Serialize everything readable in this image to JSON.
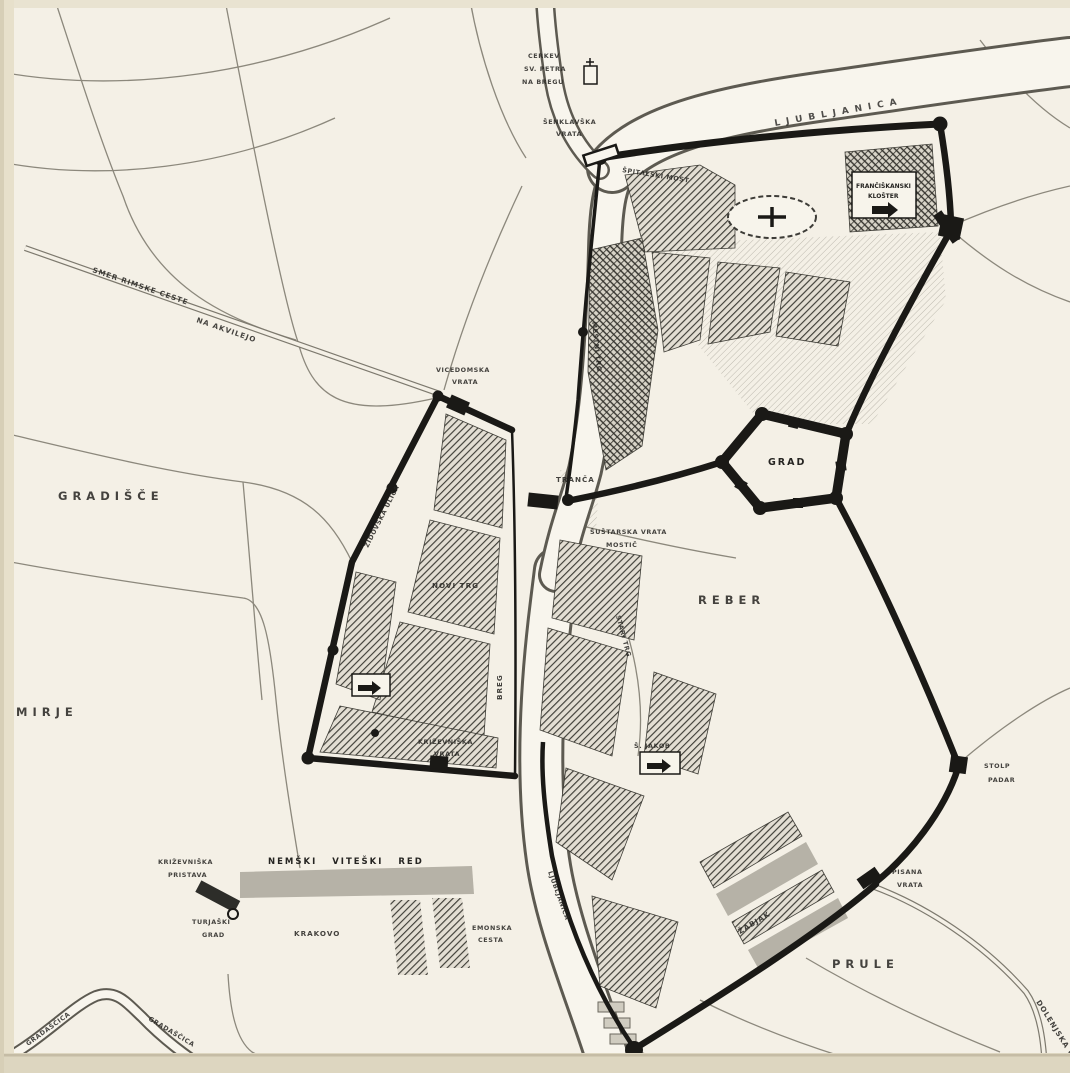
{
  "map": {
    "description_labels": {
      "river_top": "LJUBLJANICA",
      "river_south": "LJUBLJANICA",
      "stream_left": "GRADAŠČICA",
      "stream_right": "GRADAŠČICA",
      "castle": "GRAD",
      "reber": "REBER",
      "prule": "PRULE",
      "mirje": "MIRJE",
      "gradisce": "GRADIŠČE",
      "breg": "BREG",
      "roman_road_1": "SMER RIMSKE CESTE",
      "roman_road_2": "NA AKVILEJO",
      "vicedom_1": "VICEDOMSKA",
      "vicedom_2": "VRATA",
      "senklav_1": "ŠENKLAVŠKA",
      "senklav_2": "VRATA",
      "spital_bridge": "ŠPITALSKI MOST",
      "chapel_1": "CERKEV",
      "chapel_2": "SV. PETRA",
      "chapel_3": "NA BREGU",
      "franciscan_1": "FRANČIŠKANSKI",
      "franciscan_2": "KLOŠTER",
      "tranca": "TRANČA",
      "sustar_1": "ŠUŠTARSKA VRATA",
      "sustar_2": "MOSTIČ",
      "sv_jakob": "Š. JAKOB",
      "zidovska": "ŽIDOVSKA ULICA",
      "novi_trg": "NOVI TRG",
      "mestni_trg": "MESTNI TRG",
      "stari_trg": "STARI TRG",
      "krizevniska_1": "KRIŽEVNIŠKA",
      "krizevniska_2": "VRATA",
      "nemski_red": "NEMŠKI VITEŠKI RED",
      "krakovo": "KRAKOVO",
      "emonska_1": "EMONSKA",
      "emonska_2": "CESTA",
      "pristava_1": "KRIŽEVNIŠKA",
      "pristava_2": "PRISTAVA",
      "turjaski_1": "TURJAŠKI",
      "turjaski_2": "GRAD",
      "stolp_1": "STOLP",
      "stolp_2": "PADAR",
      "pisana_1": "PISANA",
      "pisana_2": "VRATA",
      "dolenjska": "DOLENJSKA C.",
      "zabjak": "ŽABJAK"
    },
    "colors": {
      "frame": "#e9e4d3",
      "paper": "#f3f1ea",
      "ink": "#161613",
      "water_edge": "#5b584f",
      "road_edge": "#8a877c",
      "gray_block": "#b5b2a8"
    }
  }
}
